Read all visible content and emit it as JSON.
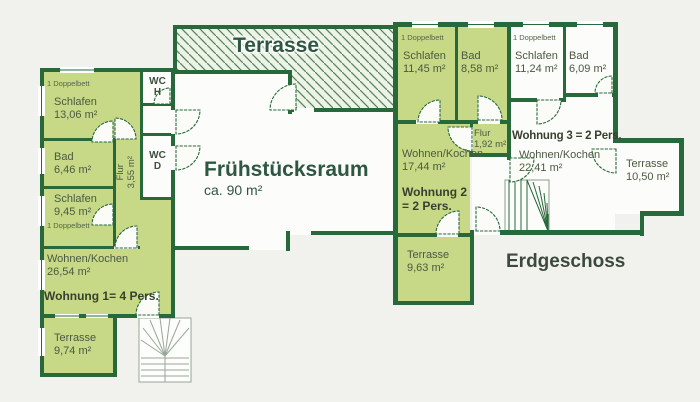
{
  "floor_plan": {
    "floor_label": "Erdgeschoss",
    "main_terrace": "Terrasse",
    "breakfast_room": {
      "name": "Frühstücksraum",
      "area": "ca. 90 m²"
    },
    "wc_h": {
      "name": "WC",
      "letter": "H"
    },
    "wc_d": {
      "name": "WC",
      "letter": "D"
    },
    "apartment_1": {
      "label": "Wohnung 1= 4 Pers.",
      "bedroom_1": {
        "note": "1 Doppelbett",
        "name": "Schlafen",
        "area": "13,06 m²"
      },
      "bath": {
        "name": "Bad",
        "area": "6,46 m²"
      },
      "hallway": {
        "name": "Flur",
        "area": "3,55 m²"
      },
      "bedroom_2": {
        "name": "Schlafen",
        "area": "9,45 m²",
        "note": "1 Doppelbett"
      },
      "living_kitchen": {
        "name": "Wohnen/Kochen",
        "area": "26,54 m²"
      },
      "terrace": {
        "name": "Terrasse",
        "area": "9,74 m²"
      }
    },
    "apartment_2": {
      "label": "Wohnung 2 = 2 Pers.",
      "bedroom": {
        "note": "1 Doppelbett",
        "name": "Schlafen",
        "area": "11,45 m²"
      },
      "bath": {
        "name": "Bad",
        "area": "8,58 m²"
      },
      "hallway": {
        "name": "Flur",
        "area": "1,92 m²"
      },
      "living_kitchen": {
        "name": "Wohnen/Kochen",
        "area": "17,44 m²"
      },
      "terrace": {
        "name": "Terrasse",
        "area": "9,63 m²"
      }
    },
    "apartment_3": {
      "label": "Wohnung 3 = 2 Pers.",
      "bedroom": {
        "note": "1 Doppelbett",
        "name": "Schlafen",
        "area": "11,24 m²"
      },
      "bath": {
        "name": "Bad",
        "area": "6,09 m²"
      },
      "living_kitchen": {
        "name": "Wohnen/Kochen",
        "area": "22,41 m²"
      },
      "terrace": {
        "name": "Terrasse",
        "area": "10,50 m²"
      }
    }
  },
  "colors": {
    "wall": "#27693a",
    "room_fill": "#c7d987",
    "hatch_line": "#57855f",
    "label_text": "#4a5a41",
    "heading_text": "#2d5741",
    "background": "#f1f1ed"
  }
}
